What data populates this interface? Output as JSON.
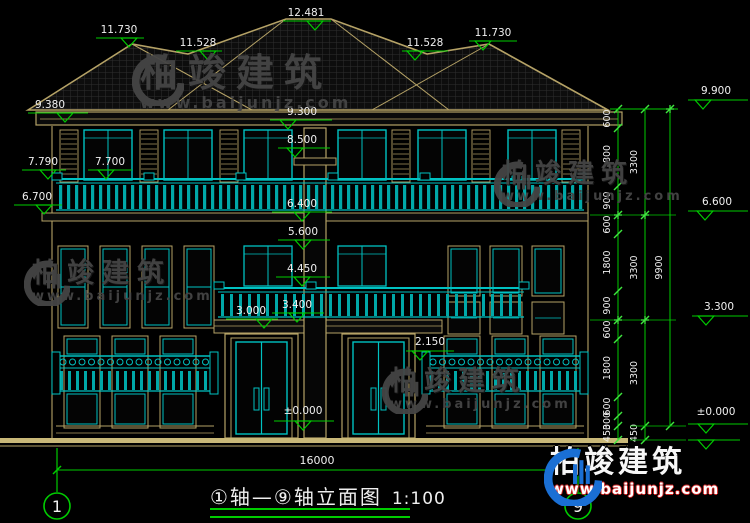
{
  "drawing": {
    "title": "①轴—⑨轴立面图",
    "scale": "1:100",
    "axis_start": "1",
    "axis_end": "9"
  },
  "dimension_chains": {
    "segments": [
      "600",
      "1800",
      "900",
      "600",
      "1800",
      "900",
      "600",
      "1800",
      "600",
      "300",
      "450"
    ],
    "floors": [
      "3300",
      "3300",
      "3300",
      "450"
    ],
    "total_height": "9900",
    "total_width": "16000"
  },
  "elevation_markers": {
    "top": [
      "11.730",
      "11.528",
      "12.481",
      "11.528",
      "11.730",
      "9.900"
    ],
    "left": [
      "9.380",
      "7.790",
      "7.700",
      "6.700"
    ],
    "center": [
      "9.300",
      "8.500",
      "6.400",
      "5.600",
      "4.450",
      "3.400",
      "3.000",
      "2.150",
      "±0.000"
    ],
    "right": [
      "6.600",
      "3.300",
      "±0.000"
    ]
  },
  "watermark": {
    "name": "柏竣建筑",
    "url": "www.baijunjz.com"
  },
  "colors": {
    "line_tan": "#b5a266",
    "line_tan_bright": "#c9b878",
    "line_cyan": "#00c2c2",
    "fill_cyan": "#00a8a8",
    "dim_green": "#00cc00",
    "dim_green_bright": "#3fe63f",
    "text_white": "#f0f0f0",
    "logo_blue": "#1a6fd4",
    "url_red": "#cc2222",
    "watermark_grey": "#454545",
    "roof_grid": "#2f2f2f"
  }
}
